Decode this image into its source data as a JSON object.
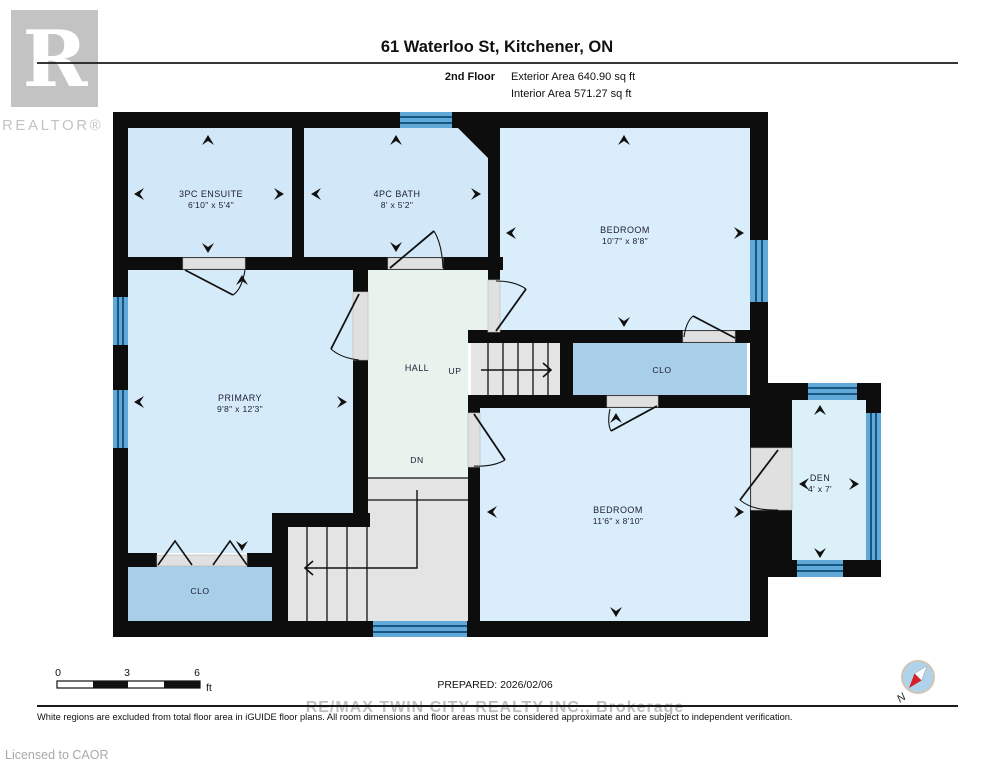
{
  "header": {
    "title": "61 Waterloo St, Kitchener, ON",
    "floor_label": "2nd Floor",
    "exterior_area": "Exterior Area 640.90 sq ft",
    "interior_area": "Interior Area 571.27 sq ft"
  },
  "branding": {
    "logo_letter": "R",
    "realtor_text": "REALTOR®",
    "licensed_text": "Licensed to CAOR",
    "watermark_text": "RE/MAX TWIN CITY REALTY INC., Brokerage"
  },
  "rooms": {
    "ensuite": {
      "name": "3PC ENSUITE",
      "dims": "6'10\" x 5'4\""
    },
    "bath": {
      "name": "4PC BATH",
      "dims": "8' x 5'2\""
    },
    "bedroom_top": {
      "name": "BEDROOM",
      "dims": "10'7\" x 8'8\""
    },
    "primary": {
      "name": "PRIMARY",
      "dims": "9'8\" x 12'3\""
    },
    "bedroom_bottom": {
      "name": "BEDROOM",
      "dims": "11'6\" x 8'10\""
    },
    "den": {
      "name": "DEN",
      "dims": "4' x 7'"
    },
    "closet_middle": {
      "name": "CLO"
    },
    "closet_primary": {
      "name": "CLO"
    },
    "hall": {
      "name": "HALL"
    },
    "stairs_up": {
      "label": "UP"
    },
    "stairs_down": {
      "label": "DN"
    }
  },
  "footer": {
    "scale_0": "0",
    "scale_3": "3",
    "scale_6": "6",
    "scale_unit": "ft",
    "prepared": "PREPARED: 2026/02/06",
    "disclaimer": "White regions are excluded from total floor area in iGUIDE floor plans. All room dimensions and floor areas must be considered approximate and are subject to independent verification.",
    "compass_north": "N"
  },
  "colors": {
    "wall": "#0d0d0d",
    "room_fill": "#d2e8f8",
    "hall_fill": "#e8f3ee",
    "closet_fill": "#a9cee8",
    "den_fill": "#dcf0f8",
    "stairs_fill": "#e4e4e4",
    "window_blue": "#5fa8d8",
    "window_stripe": "#19567f",
    "watermark_gray": "#bfbfbf",
    "compass_red": "#d42027"
  }
}
